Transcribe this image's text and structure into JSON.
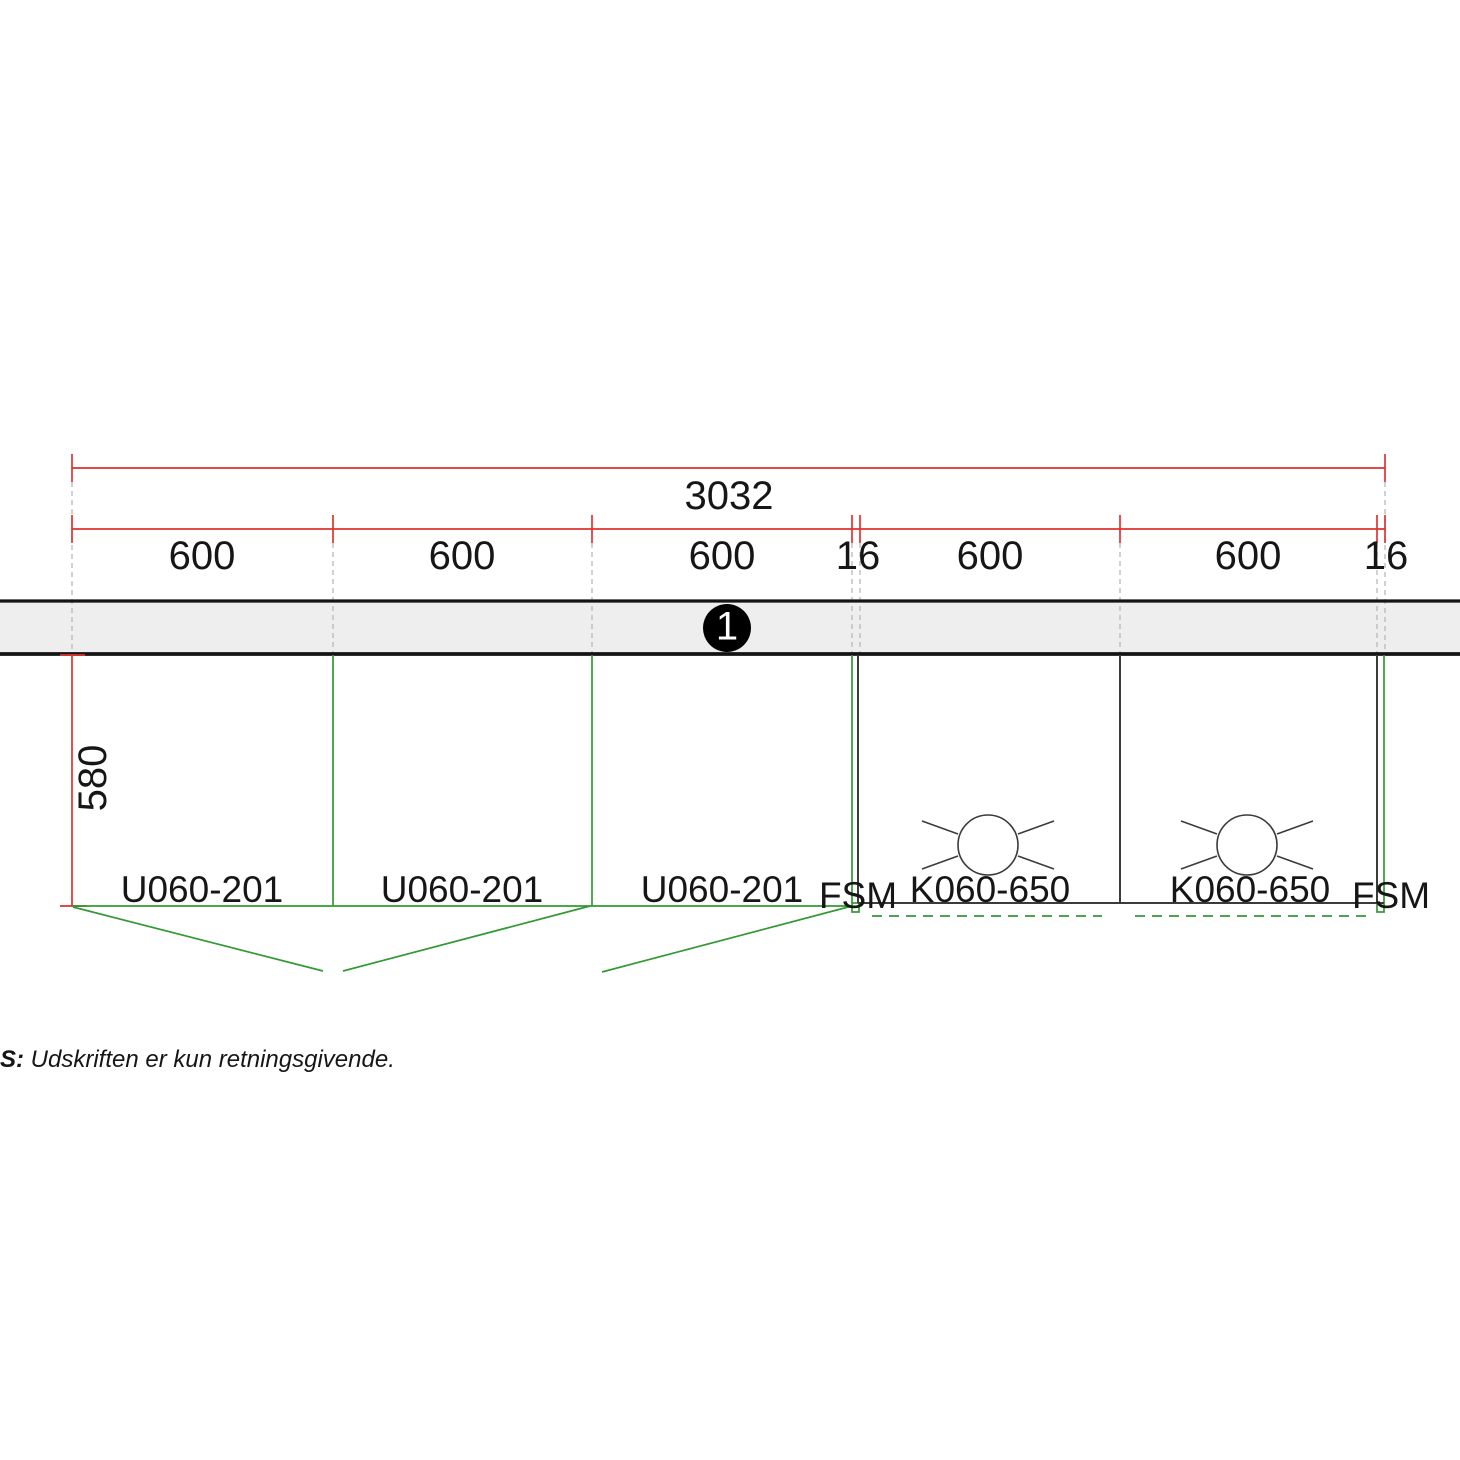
{
  "dimensions": {
    "total": "3032",
    "segments": [
      "600",
      "600",
      "600",
      "16",
      "600",
      "600",
      "16"
    ],
    "depth": "580"
  },
  "wall_section": {
    "marker": "1"
  },
  "cabinets": {
    "base_units": [
      "U060-201",
      "U060-201",
      "U060-201"
    ],
    "wall_units": [
      "K060-650",
      "K060-650"
    ],
    "fillers": [
      "FSM",
      "FSM"
    ]
  },
  "symbols": {
    "lamp": "ceiling-lamp"
  },
  "note": {
    "prefix": "S:",
    "text": " Udskriften er kun retningsgivende."
  },
  "colors": {
    "dimension_red": "#dd3330",
    "unit_green": "#339933",
    "extension_gray": "#b8b8b8",
    "wall_fill": "#eeeeee",
    "wall_border": "#141414",
    "line_dark": "#3b3b3b"
  }
}
